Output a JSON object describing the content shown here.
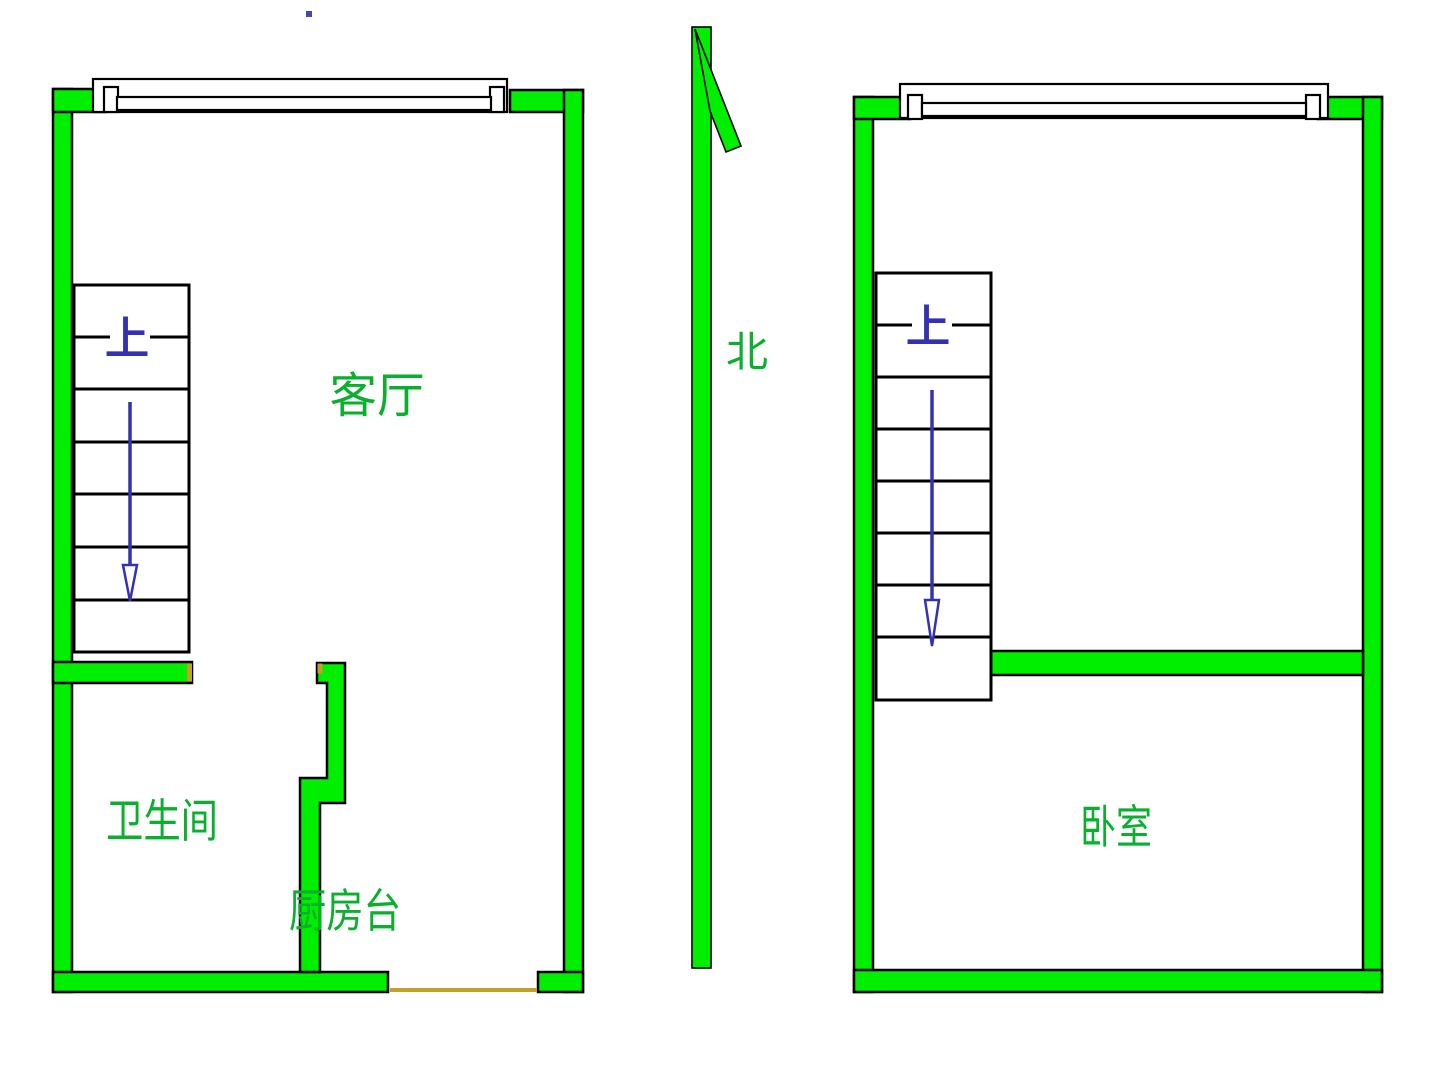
{
  "compass": {
    "label": "北"
  },
  "plans": [
    {
      "name": "first-floor",
      "stairs": {
        "direction_label": "上"
      },
      "rooms": [
        {
          "name": "living-room",
          "label": "客厅"
        },
        {
          "name": "bathroom",
          "label": "卫生间"
        },
        {
          "name": "kitchen-counter",
          "label": "厨房台"
        }
      ]
    },
    {
      "name": "second-floor",
      "stairs": {
        "direction_label": "上"
      },
      "rooms": [
        {
          "name": "bedroom",
          "label": "卧室"
        }
      ]
    }
  ],
  "colors": {
    "wall_fill": "#00EE00",
    "wall_outline": "#000000",
    "room_label": "#0AAF2D",
    "stair_annotation": "#3232B2",
    "door_accent": "#C4A028",
    "background": "#FFFFFF"
  }
}
